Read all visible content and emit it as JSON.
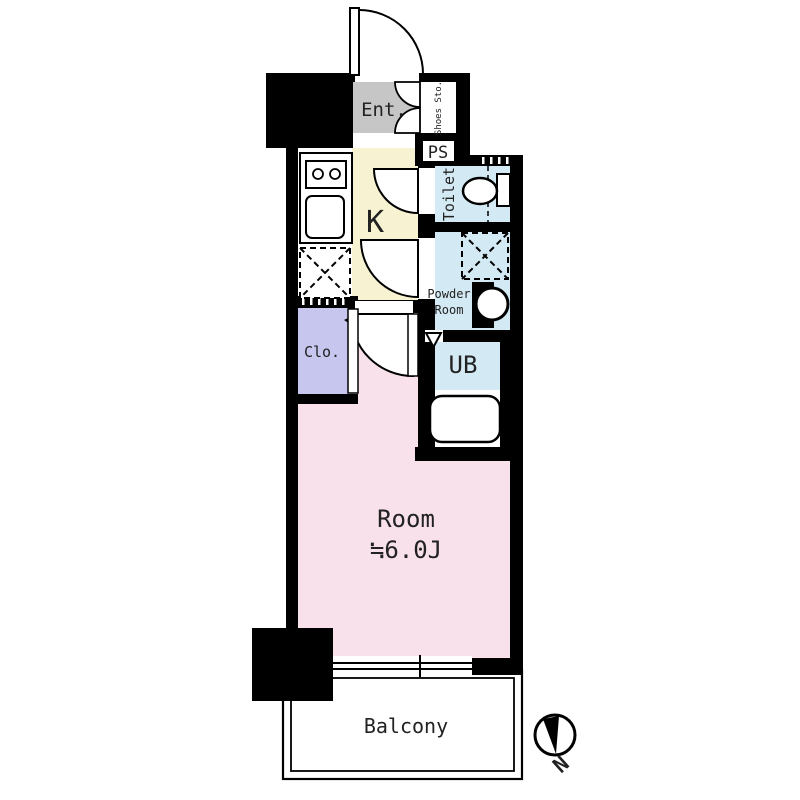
{
  "plan": {
    "type": "apartment-floor-plan",
    "rooms": {
      "entrance": {
        "label": "Ent."
      },
      "shoe_storage": {
        "label": "Shoes Sto."
      },
      "pipe_space": {
        "label": "PS"
      },
      "toilet": {
        "label": "Toilet"
      },
      "kitchen": {
        "label": "K"
      },
      "powder_room": {
        "label_line1": "Powder",
        "label_line2": "Room"
      },
      "closet": {
        "label": "Clo."
      },
      "unit_bath": {
        "label": "UB"
      },
      "main_room": {
        "label": "Room",
        "size": "≒6.0J"
      },
      "balcony": {
        "label": "Balcony"
      }
    },
    "compass": {
      "label": "N"
    },
    "colors": {
      "wall": "#000000",
      "entrance": "#c6c6c6",
      "kitchen": "#f7f3d2",
      "water_rooms": "#d3e9f3",
      "closet": "#c6c6ef",
      "main_room": "#f8e1ea",
      "white": "#ffffff"
    }
  }
}
